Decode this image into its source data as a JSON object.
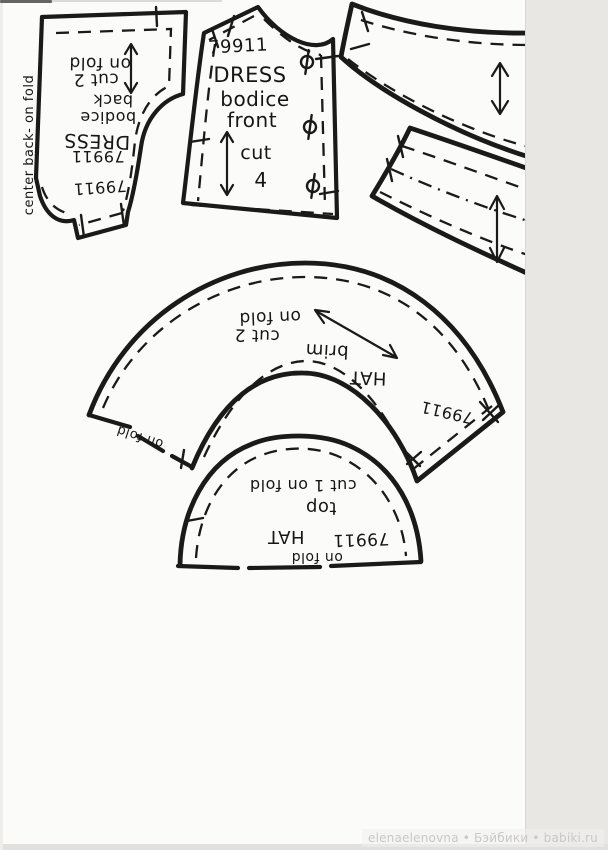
{
  "page": {
    "paper_color": "#fbfbf9",
    "scanner_background": "#e8e7e4",
    "ink_color": "#1a1a1a",
    "watermark_color": "#c9c8c6"
  },
  "watermark": {
    "text": "elenaelenovna • Бэйбики • babiki.ru"
  },
  "icons": {
    "grainline": "double-headed-arrow",
    "button_mark": "circle-with-line",
    "notch": "cross-tick"
  },
  "pieces": {
    "dress_bodice_back": {
      "fold": "on fold",
      "cut": "cut 2",
      "part2": "back",
      "part1": "bodice",
      "garment": "DRESS",
      "number": "79911",
      "number2": "79911",
      "edge_label": "center back- on fold"
    },
    "dress_bodice_front": {
      "number": "79911",
      "garment": "DRESS",
      "part1": "bodice",
      "part2": "front",
      "cut": "cut",
      "qty": "4"
    },
    "hat_brim": {
      "fold": "on fold",
      "cut": "cut 2",
      "part": "brim",
      "garment": "HAT",
      "number": "79911",
      "edge_fold": "on fold"
    },
    "hat_top": {
      "cut": "cut 1 on fold",
      "part": "top",
      "garment": "HAT",
      "number": "79911",
      "edge_fold": "on fold"
    }
  }
}
